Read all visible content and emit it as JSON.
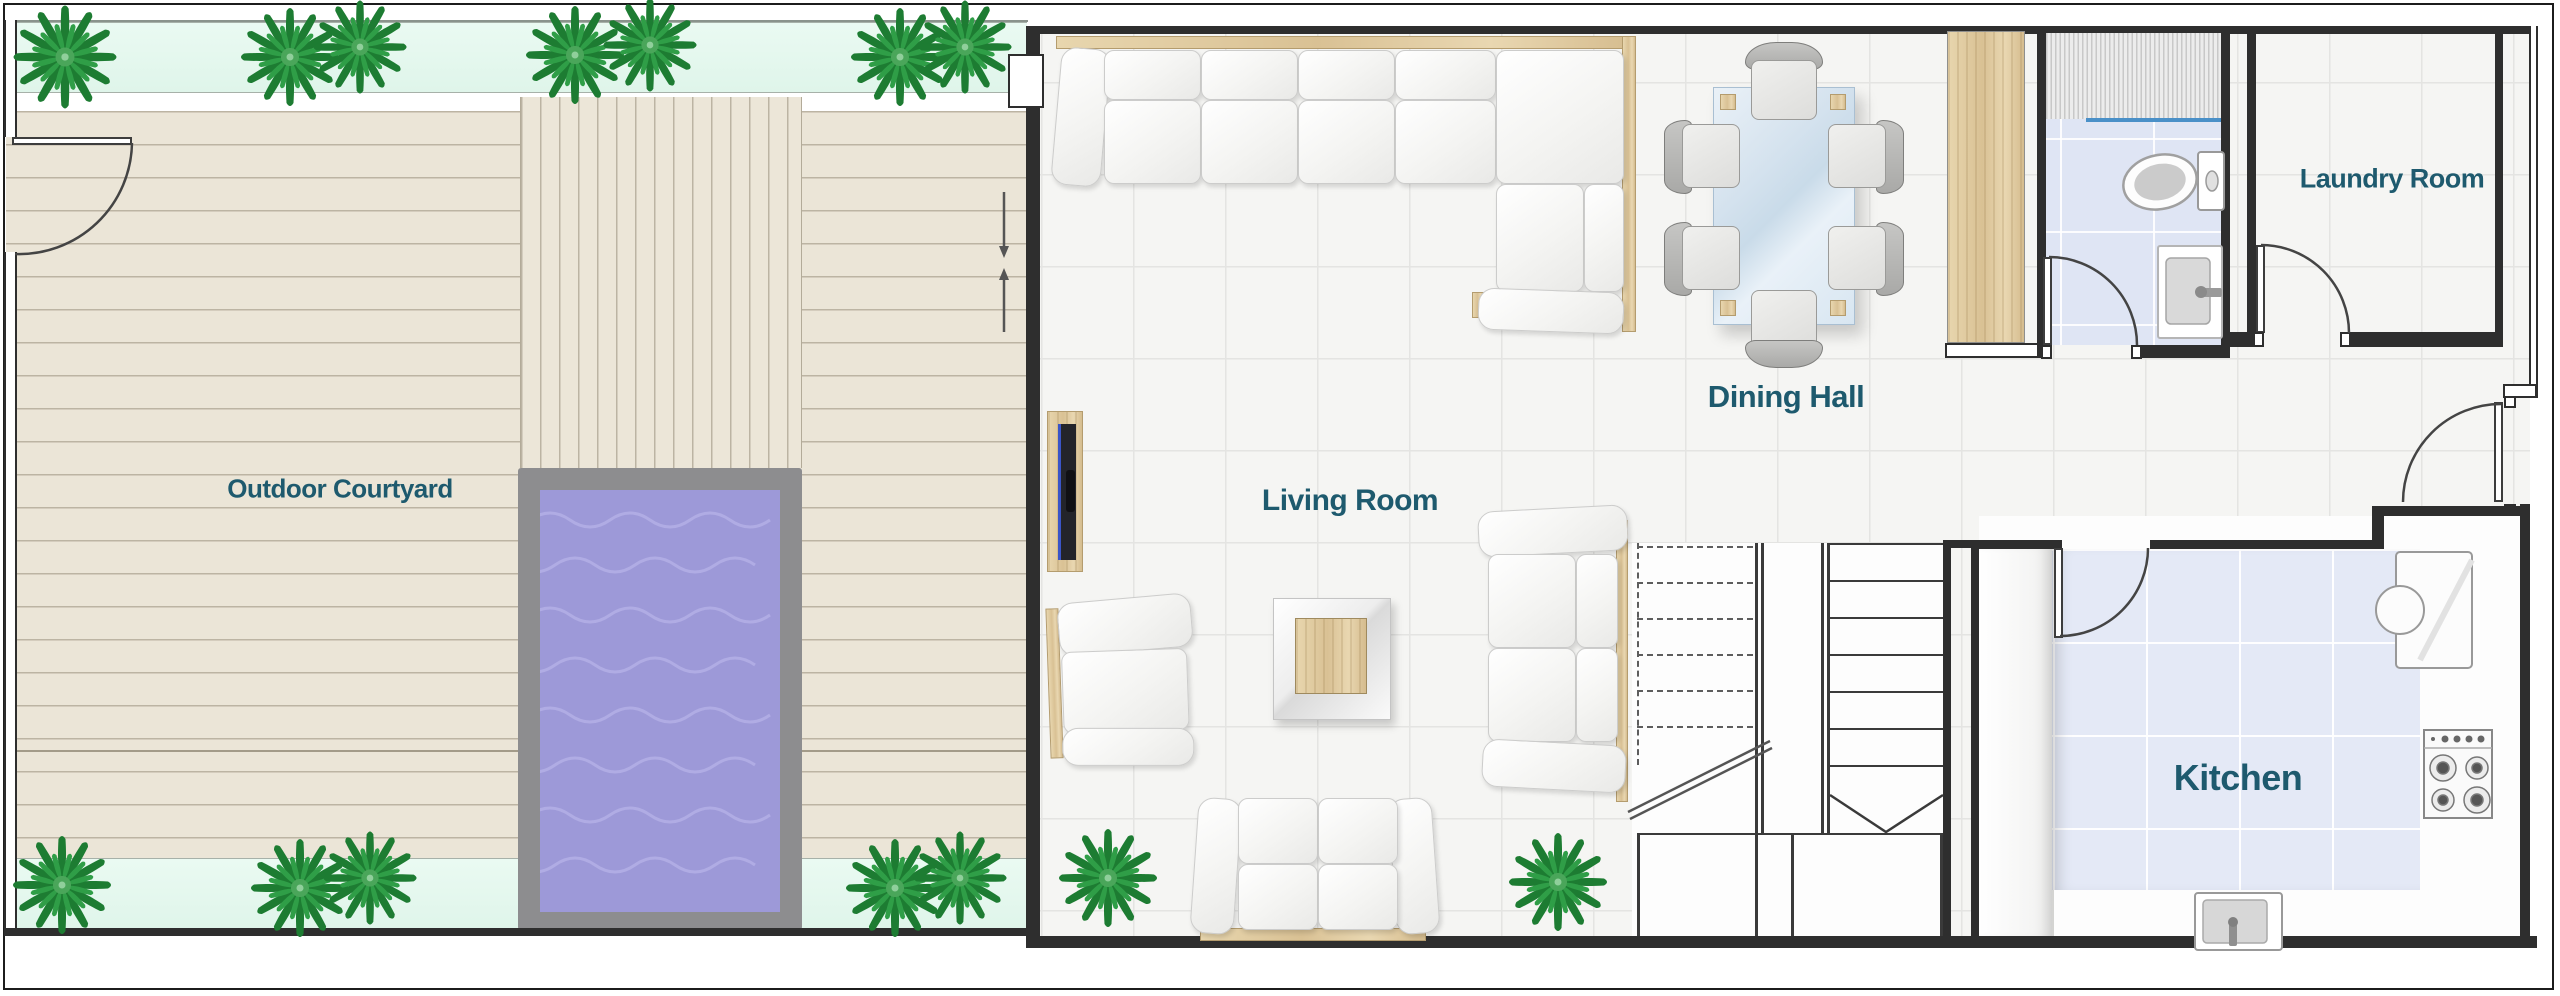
{
  "labels": {
    "outdoor_courtyard": "Outdoor Courtyard",
    "living_room": "Living Room",
    "dining_hall": "Dining Hall",
    "laundry_room": "Laundry Room",
    "kitchen": "Kitchen"
  },
  "palette": {
    "label_text": "#1e5a6e",
    "wall": "#2e2e2e",
    "pool_water": "#9d99d8",
    "pool_frame": "#8d8d8f",
    "deck": "#ebe5d7",
    "mint_planter": "#e7f9f0",
    "wood": "#ddc79c",
    "kitchen_floor": "#e4e9f6",
    "bathroom_floor": "#dfe5f4",
    "floor_tile": "#f5f5f3",
    "shower_glass_line": "#4a90c8"
  },
  "objects": {
    "outdoor_courtyard": [
      "swimming-pool",
      "timber-deck",
      "boardwalk-strip",
      "planter-strips"
    ],
    "living_room": [
      "l-shaped-sectional-sofa",
      "two-seater-sofa",
      "loveseat",
      "armchair",
      "coffee-table",
      "tv-console"
    ],
    "dining_hall": [
      "glass-dining-table",
      "dining-chairs"
    ],
    "bathroom": [
      "shower",
      "toilet",
      "washbasin"
    ],
    "kitchen": [
      "refrigerator",
      "gas-hob",
      "sink",
      "counters"
    ],
    "circulation": [
      "staircase-up",
      "staircase-down",
      "entrance-door"
    ]
  },
  "counts": {
    "plants": 14,
    "dining_chairs": 6,
    "door_swings": 5
  }
}
